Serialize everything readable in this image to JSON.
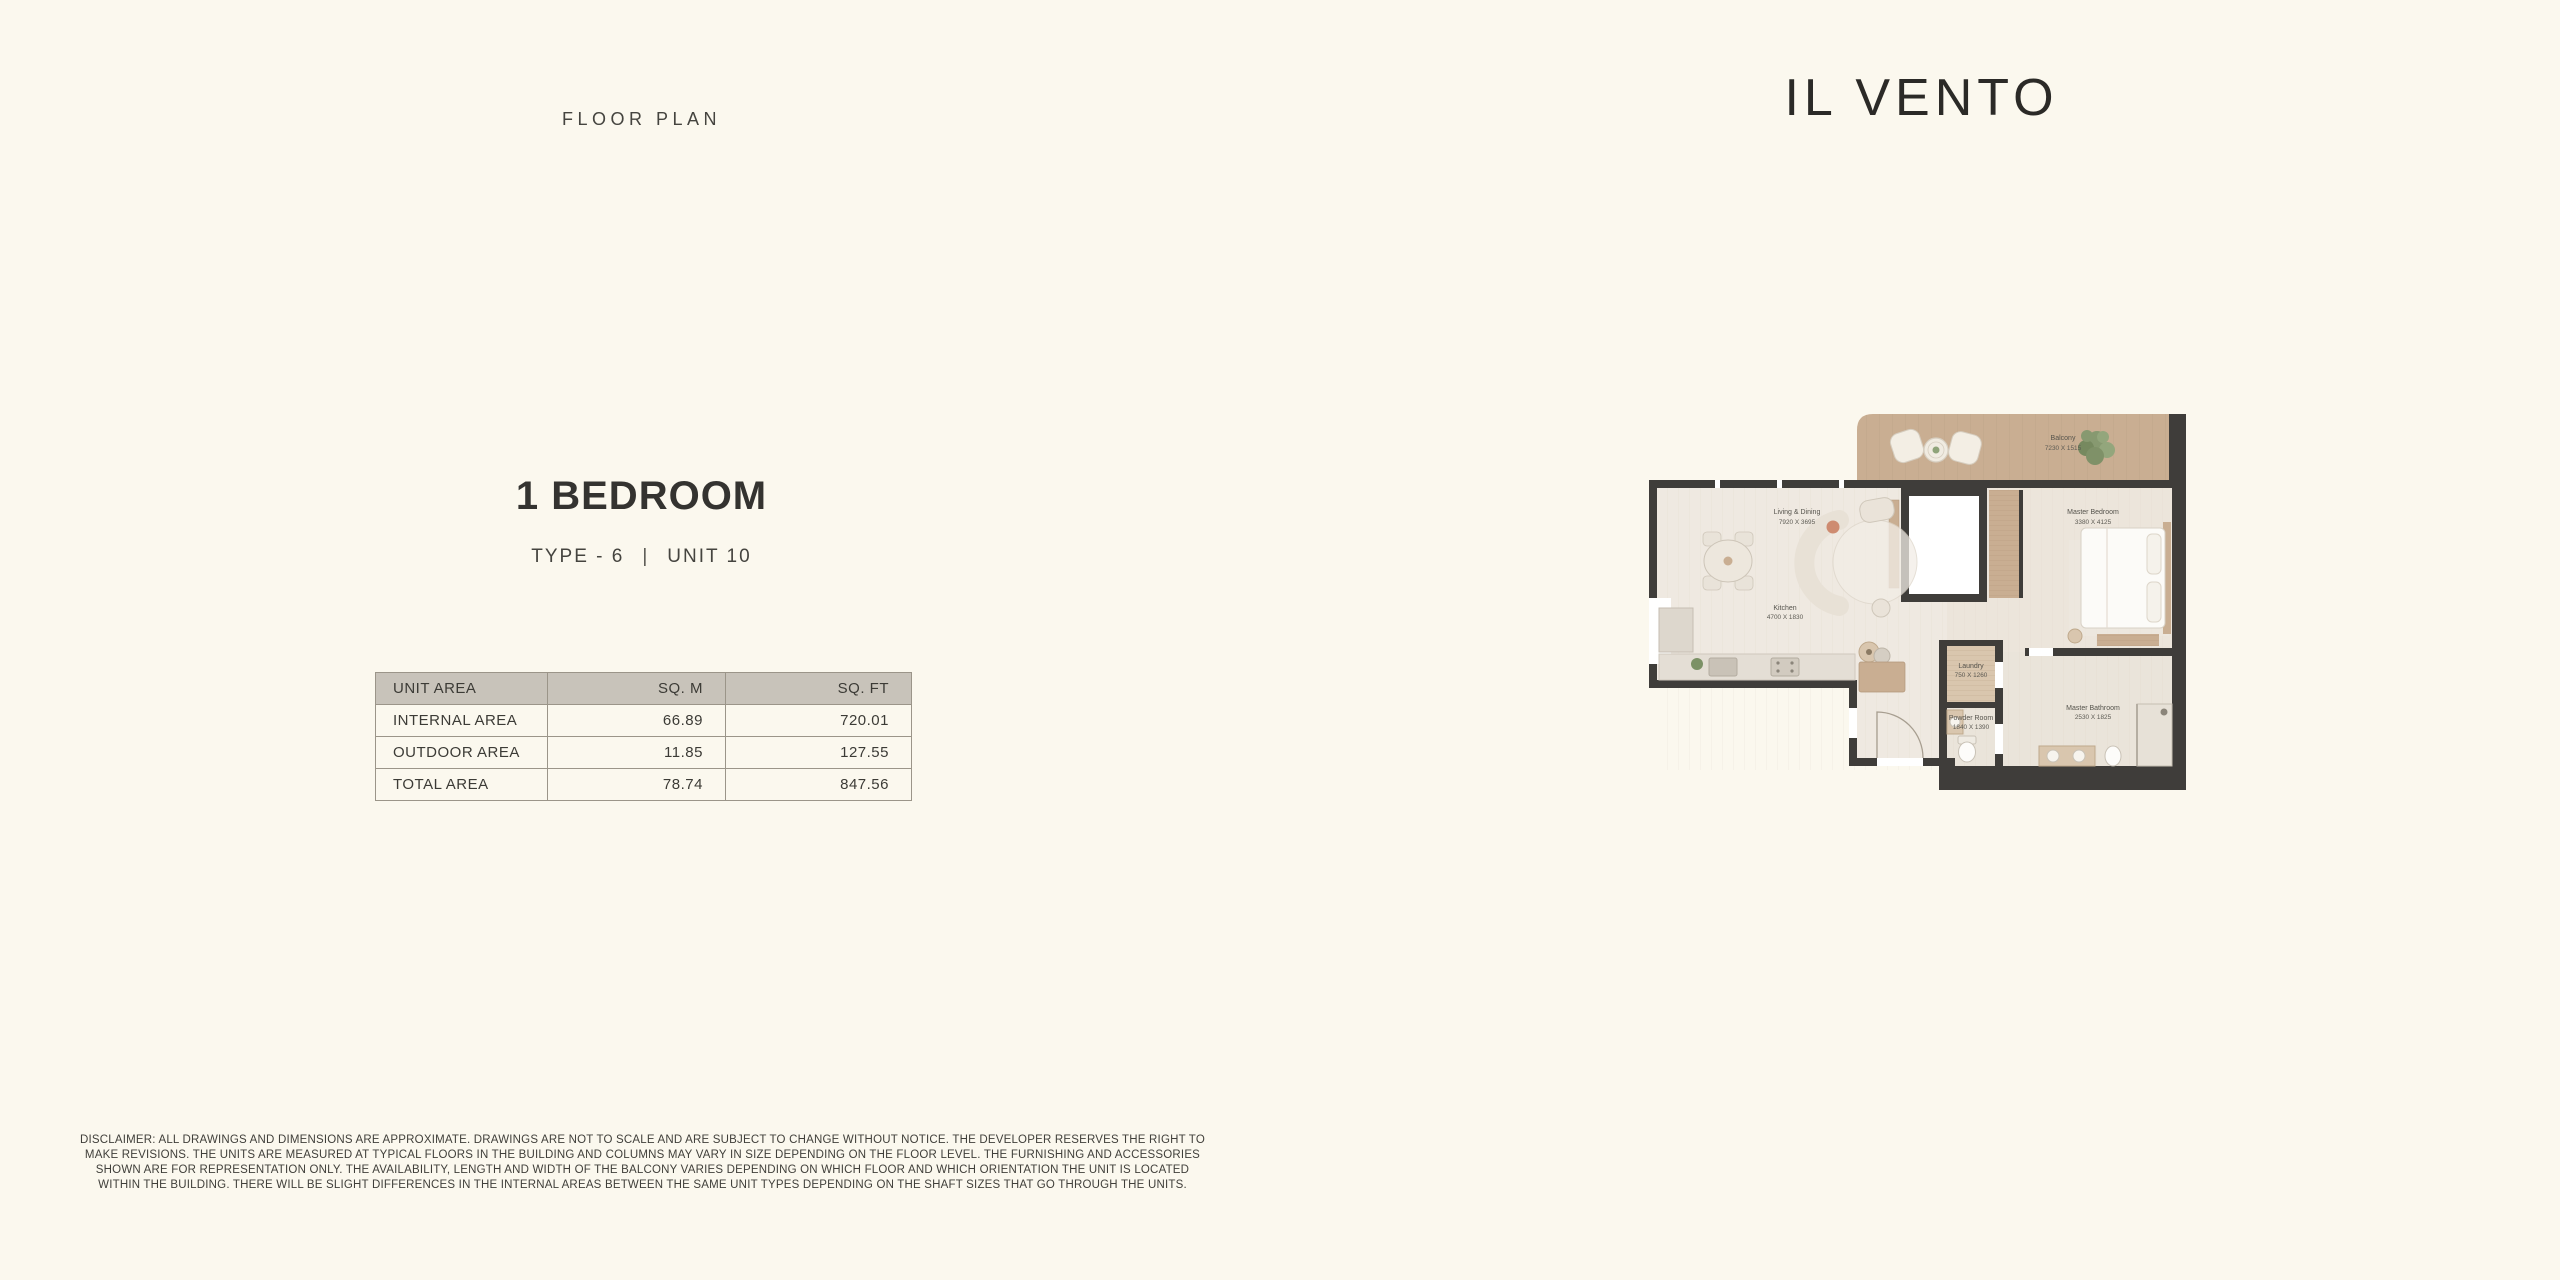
{
  "header": {
    "floor_plan_label": "FLOOR PLAN"
  },
  "brand": {
    "name": "IL VENTO"
  },
  "unit": {
    "title": "1 BEDROOM",
    "type": "TYPE - 6",
    "divider": "|",
    "unit_no": "UNIT 10"
  },
  "area_table": {
    "headers": [
      "UNIT AREA",
      "SQ. M",
      "SQ. FT"
    ],
    "rows": [
      {
        "label": "INTERNAL AREA",
        "sqm": "66.89",
        "sqft": "720.01"
      },
      {
        "label": "OUTDOOR AREA",
        "sqm": "11.85",
        "sqft": "127.55"
      },
      {
        "label": "TOTAL AREA",
        "sqm": "78.74",
        "sqft": "847.56"
      }
    ]
  },
  "floor_plan": {
    "rooms": [
      {
        "name": "Balcony",
        "dims": "7230 X 1515"
      },
      {
        "name": "Living & Dining",
        "dims": "7920 X 3695"
      },
      {
        "name": "Kitchen",
        "dims": "4700 X 1830"
      },
      {
        "name": "Master Bedroom",
        "dims": "3380 X 4125"
      },
      {
        "name": "Laundry",
        "dims": "750 X 1260"
      },
      {
        "name": "Powder Room",
        "dims": "1840 X 1390"
      },
      {
        "name": "Master Bathroom",
        "dims": "2530 X 1825"
      }
    ],
    "colors": {
      "wall": "#3F3D3A",
      "wood": "#C9AE92",
      "floor": "#EFE9E1",
      "background": "#FBF8EE"
    }
  },
  "disclaimer": "DISCLAIMER: ALL DRAWINGS AND DIMENSIONS ARE APPROXIMATE. DRAWINGS ARE NOT TO SCALE AND ARE SUBJECT TO CHANGE WITHOUT NOTICE. THE DEVELOPER RESERVES THE RIGHT TO MAKE REVISIONS. THE UNITS ARE MEASURED AT TYPICAL FLOORS IN THE BUILDING AND COLUMNS MAY VARY IN SIZE DEPENDING ON THE FLOOR LEVEL. THE FURNISHING AND ACCESSORIES SHOWN ARE FOR REPRESENTATION ONLY. THE AVAILABILITY, LENGTH AND WIDTH OF THE BALCONY VARIES DEPENDING ON WHICH FLOOR AND WHICH ORIENTATION THE UNIT IS LOCATED WITHIN THE BUILDING. THERE WILL BE SLIGHT DIFFERENCES IN THE INTERNAL AREAS BETWEEN THE SAME UNIT TYPES DEPENDING ON THE SHAFT SIZES THAT GO THROUGH THE UNITS."
}
